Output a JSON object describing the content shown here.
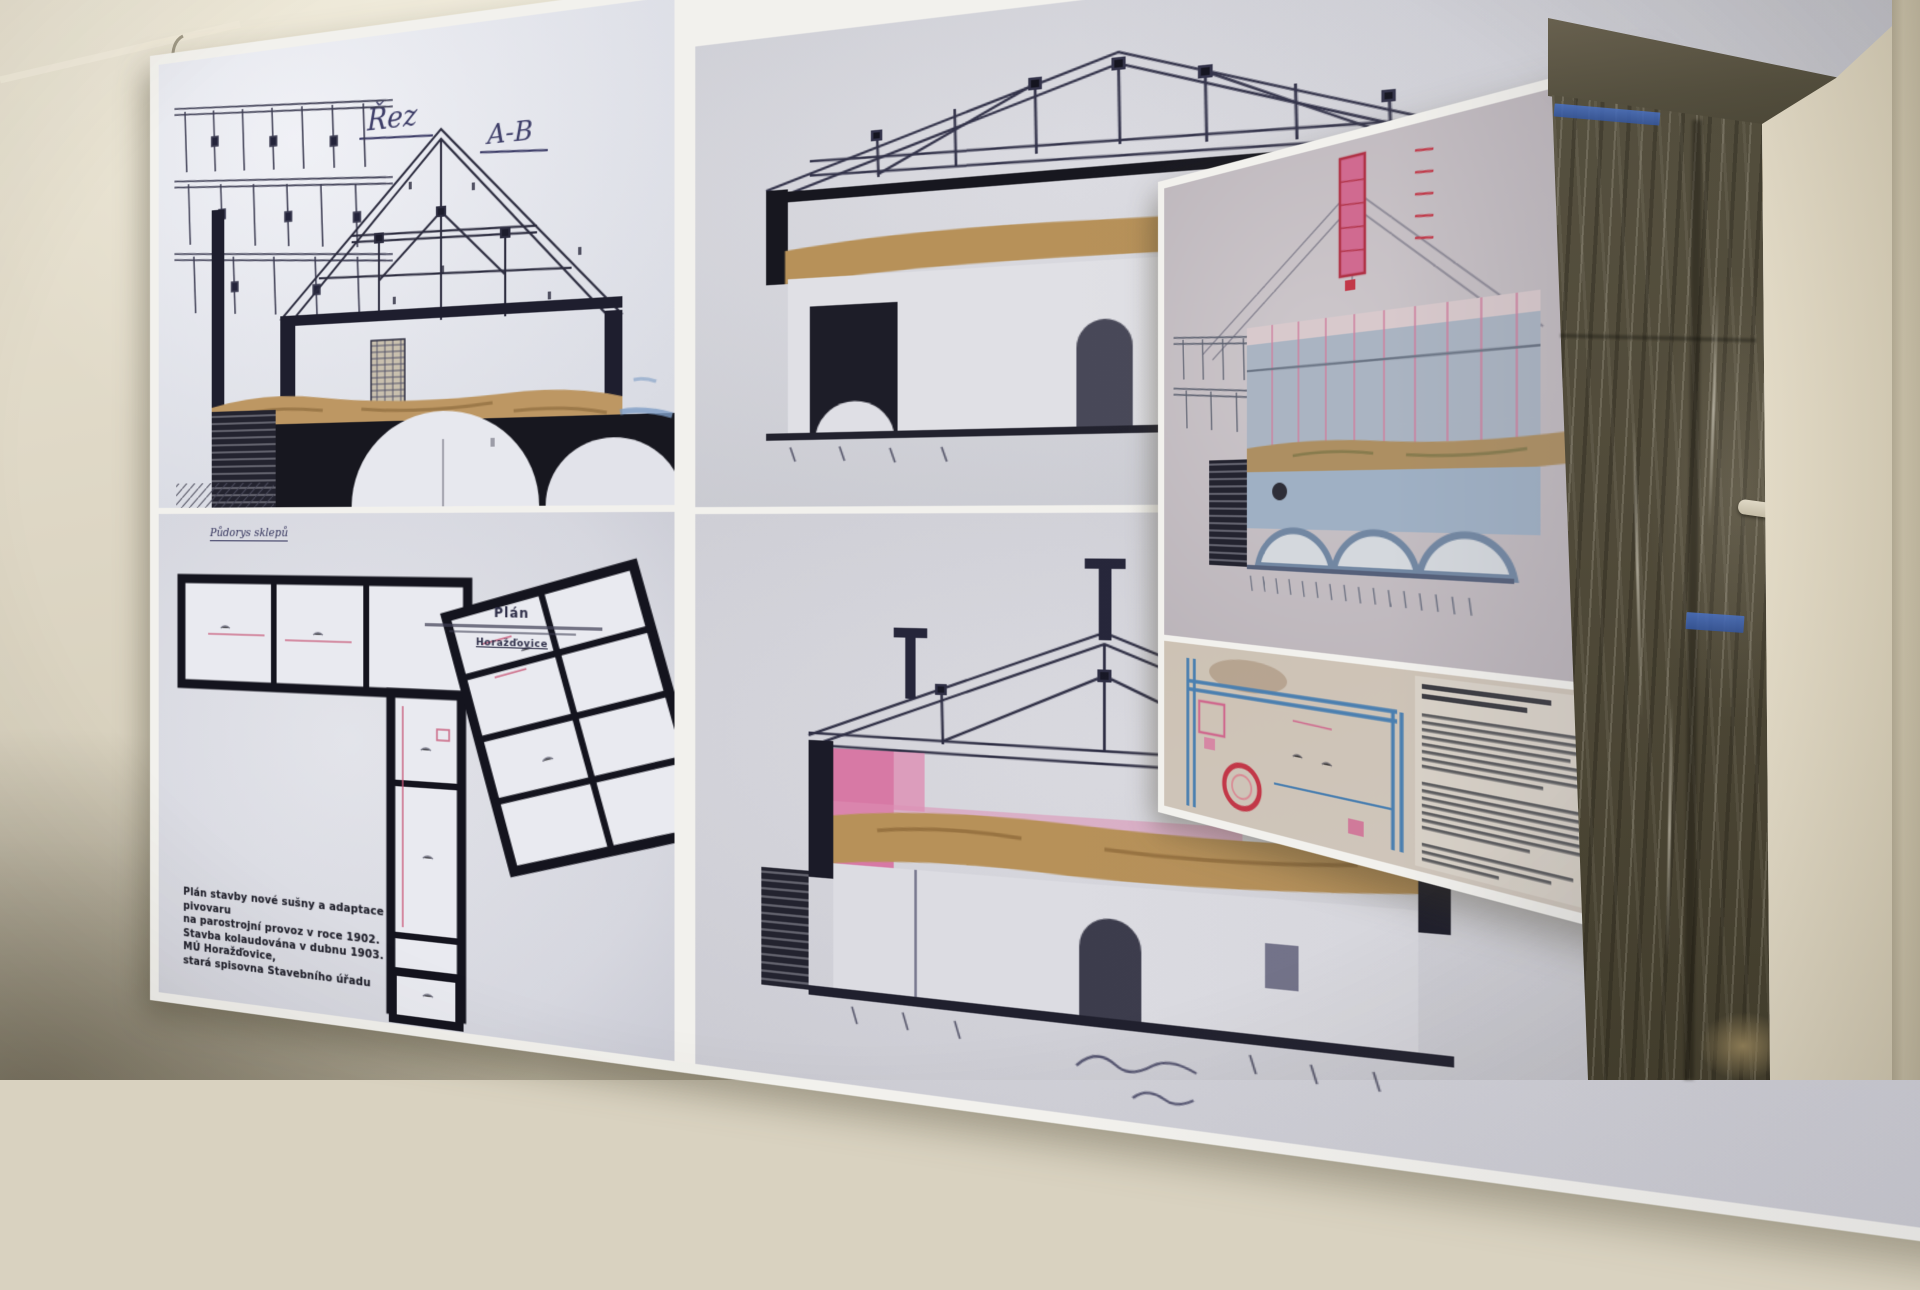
{
  "left_panel": {
    "section_ab": {
      "label_word1": "Řez",
      "label_word2": "A-B"
    },
    "section_cd": {
      "label": "Řez C-D"
    },
    "section_ef": {
      "label": "Řez E-F"
    },
    "cellar_plan": {
      "corner_label": "Půdorys sklepů",
      "title": "Plán",
      "title_place": "Horažďovice",
      "caption_lines": [
        "Plán stavby nové sušny a adaptace pivovaru",
        "na parostrojní provoz v roce 1902.",
        "Stavba kolaudována v dubnu 1903.",
        "MÚ Horažďovice,",
        "stará spisovna Stavebního úřadu"
      ]
    }
  },
  "colors": {
    "wall_cream": "#ddd6c4",
    "poster_white": "#f2f1ed",
    "drawing_ink": "#2b2b3e",
    "vault_tan": "#bd9763",
    "highlight_pink": "#d487a8",
    "accent_red": "#c23848",
    "watercolor_blue": "#7d9cc4",
    "plan_blue": "#4a7fb0",
    "tape_blue": "#3f66b8",
    "plastic_olive": "#514b3a"
  }
}
